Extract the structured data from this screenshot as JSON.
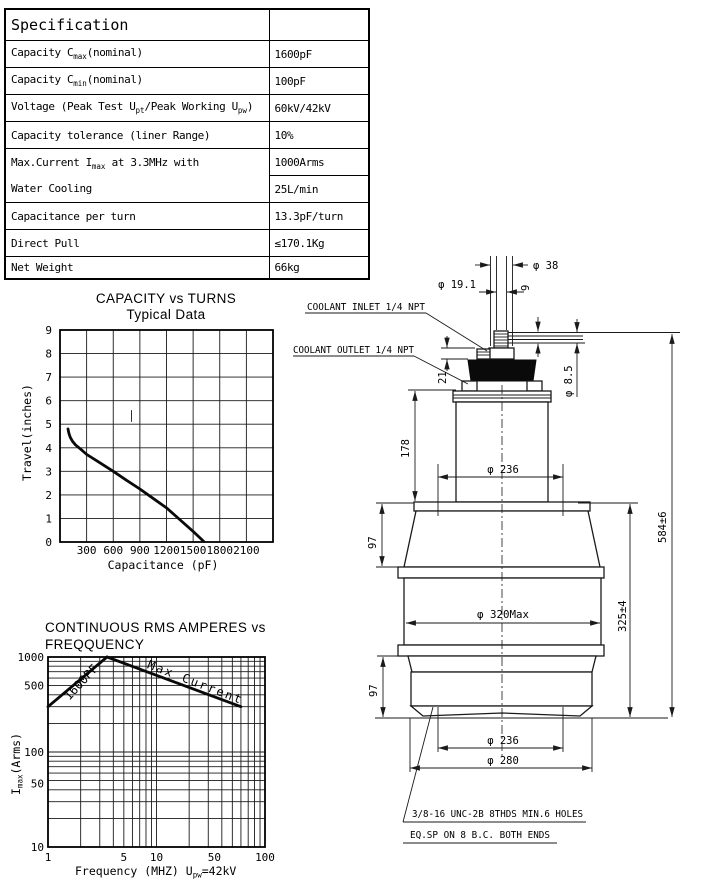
{
  "table": {
    "header": "Specification",
    "rows": [
      {
        "label": "Capacity C<sub>max</sub>(nominal)",
        "value": "1600pF"
      },
      {
        "label": "Capacity C<sub>min</sub>(nominal)",
        "value": "100pF"
      },
      {
        "label": "Voltage (Peak Test U<sub>pt</sub>/Peak Working U<sub>pw</sub>)",
        "value": "60kV/42kV"
      },
      {
        "label": "Capacity tolerance (liner Range)",
        "value": "10%"
      },
      {
        "label": "Max.Current I<sub>max</sub> at 3.3MHz with",
        "label2": "Water Cooling",
        "value": "1000Arms",
        "value2": "25L/min"
      },
      {
        "label": "Capacitance per turn",
        "value": "13.3pF/turn"
      },
      {
        "label": "Direct Pull",
        "value": "≤170.1Kg"
      },
      {
        "label": "Net Weight",
        "value": "66kg"
      }
    ]
  },
  "chart_data": [
    {
      "type": "line",
      "title": "CAPACITY vs TURNS",
      "subtitle": "Typical Data",
      "xlabel": "Capacitance (pF)",
      "ylabel": "Travel(inches)",
      "xlim": [
        0,
        2400
      ],
      "ylim": [
        0,
        9
      ],
      "xgrid_step": 300,
      "ygrid_step": 1,
      "grid": true,
      "legend": false,
      "xticks": [
        300,
        600,
        900,
        1200,
        1500,
        1800,
        2100
      ],
      "yticks": [
        0,
        1,
        2,
        3,
        4,
        5,
        6,
        7,
        8,
        9
      ],
      "series": [
        {
          "name": "travel-vs-capacitance",
          "x": [
            90,
            100,
            115,
            140,
            175,
            230,
            300,
            450,
            600,
            750,
            900,
            1050,
            1200,
            1350,
            1500,
            1620
          ],
          "y": [
            4.8,
            4.62,
            4.45,
            4.28,
            4.12,
            3.95,
            3.72,
            3.36,
            3.0,
            2.62,
            2.25,
            1.85,
            1.45,
            0.95,
            0.45,
            0.02
          ]
        }
      ],
      "stray_mark": {
        "x": 805,
        "y1": 5.1,
        "y2": 5.6
      }
    },
    {
      "type": "line",
      "scale": "log-log",
      "title": "CONTINUOUS RMS AMPERES vs",
      "subtitle": "FREQQUENCY",
      "xlabel_segments": [
        {
          "t": "Frequency (MHZ) U"
        },
        {
          "t": "pw",
          "sub": true
        },
        {
          "t": "=42kV"
        }
      ],
      "ylabel_segments": [
        {
          "t": "I"
        },
        {
          "t": "max",
          "sub": true
        },
        {
          "t": "(Arms)"
        }
      ],
      "xlim": [
        1,
        100
      ],
      "ylim": [
        10,
        1000
      ],
      "grid": true,
      "legend": false,
      "xticks": [
        {
          "v": 1,
          "label": "1"
        },
        {
          "v": 5,
          "label": "5"
        },
        {
          "v": 10,
          "label": "10"
        },
        {
          "v": 50,
          "label": "50",
          "dx": -18
        },
        {
          "v": 100,
          "label": "100"
        }
      ],
      "yticks": [
        {
          "v": 1000,
          "label": "1000"
        },
        {
          "v": 500,
          "label": "500"
        },
        {
          "v": 100,
          "label": "100"
        },
        {
          "v": 50,
          "label": "50",
          "dy": 3
        },
        {
          "v": 10,
          "label": "10"
        }
      ],
      "series": [
        {
          "name": "rating-1600pf",
          "label": "1600PF",
          "points": [
            [
              1,
              300
            ],
            [
              3.5,
              1000
            ]
          ],
          "label_xy": [
            84,
            685
          ],
          "label_rot": -47
        },
        {
          "name": "max-current",
          "label": "Max Current",
          "label_ls": "2",
          "points": [
            [
              3.5,
              1000
            ],
            [
              60,
              300
            ]
          ],
          "label_xy": [
            194,
            686
          ],
          "label_rot": 21
        }
      ]
    }
  ],
  "drawing": {
    "coolant_inlet": "COOLANT INLET 1/4 NPT",
    "coolant_outlet": "COOLANT OUTLET 1/4 NPT",
    "dia_38": "φ 38",
    "dia_19_1": "φ 19.1",
    "dim_9": "9",
    "dia_8_5": "φ 8.5",
    "dim_21": "21",
    "dim_178": "178",
    "dia_236_top": "φ 236",
    "dim_97_top": "97",
    "dia_320": "φ 320Max",
    "dim_325": "325±4",
    "dim_584": "584±6",
    "dim_97_bottom": "97",
    "dia_236_bottom": "φ 236",
    "dia_280": "φ 280",
    "note_line1": "3/8-16 UNC-2B 8THDS MIN.6 HOLES",
    "note_line2": "EQ.SP ON 8 B.C. BOTH ENDS"
  }
}
